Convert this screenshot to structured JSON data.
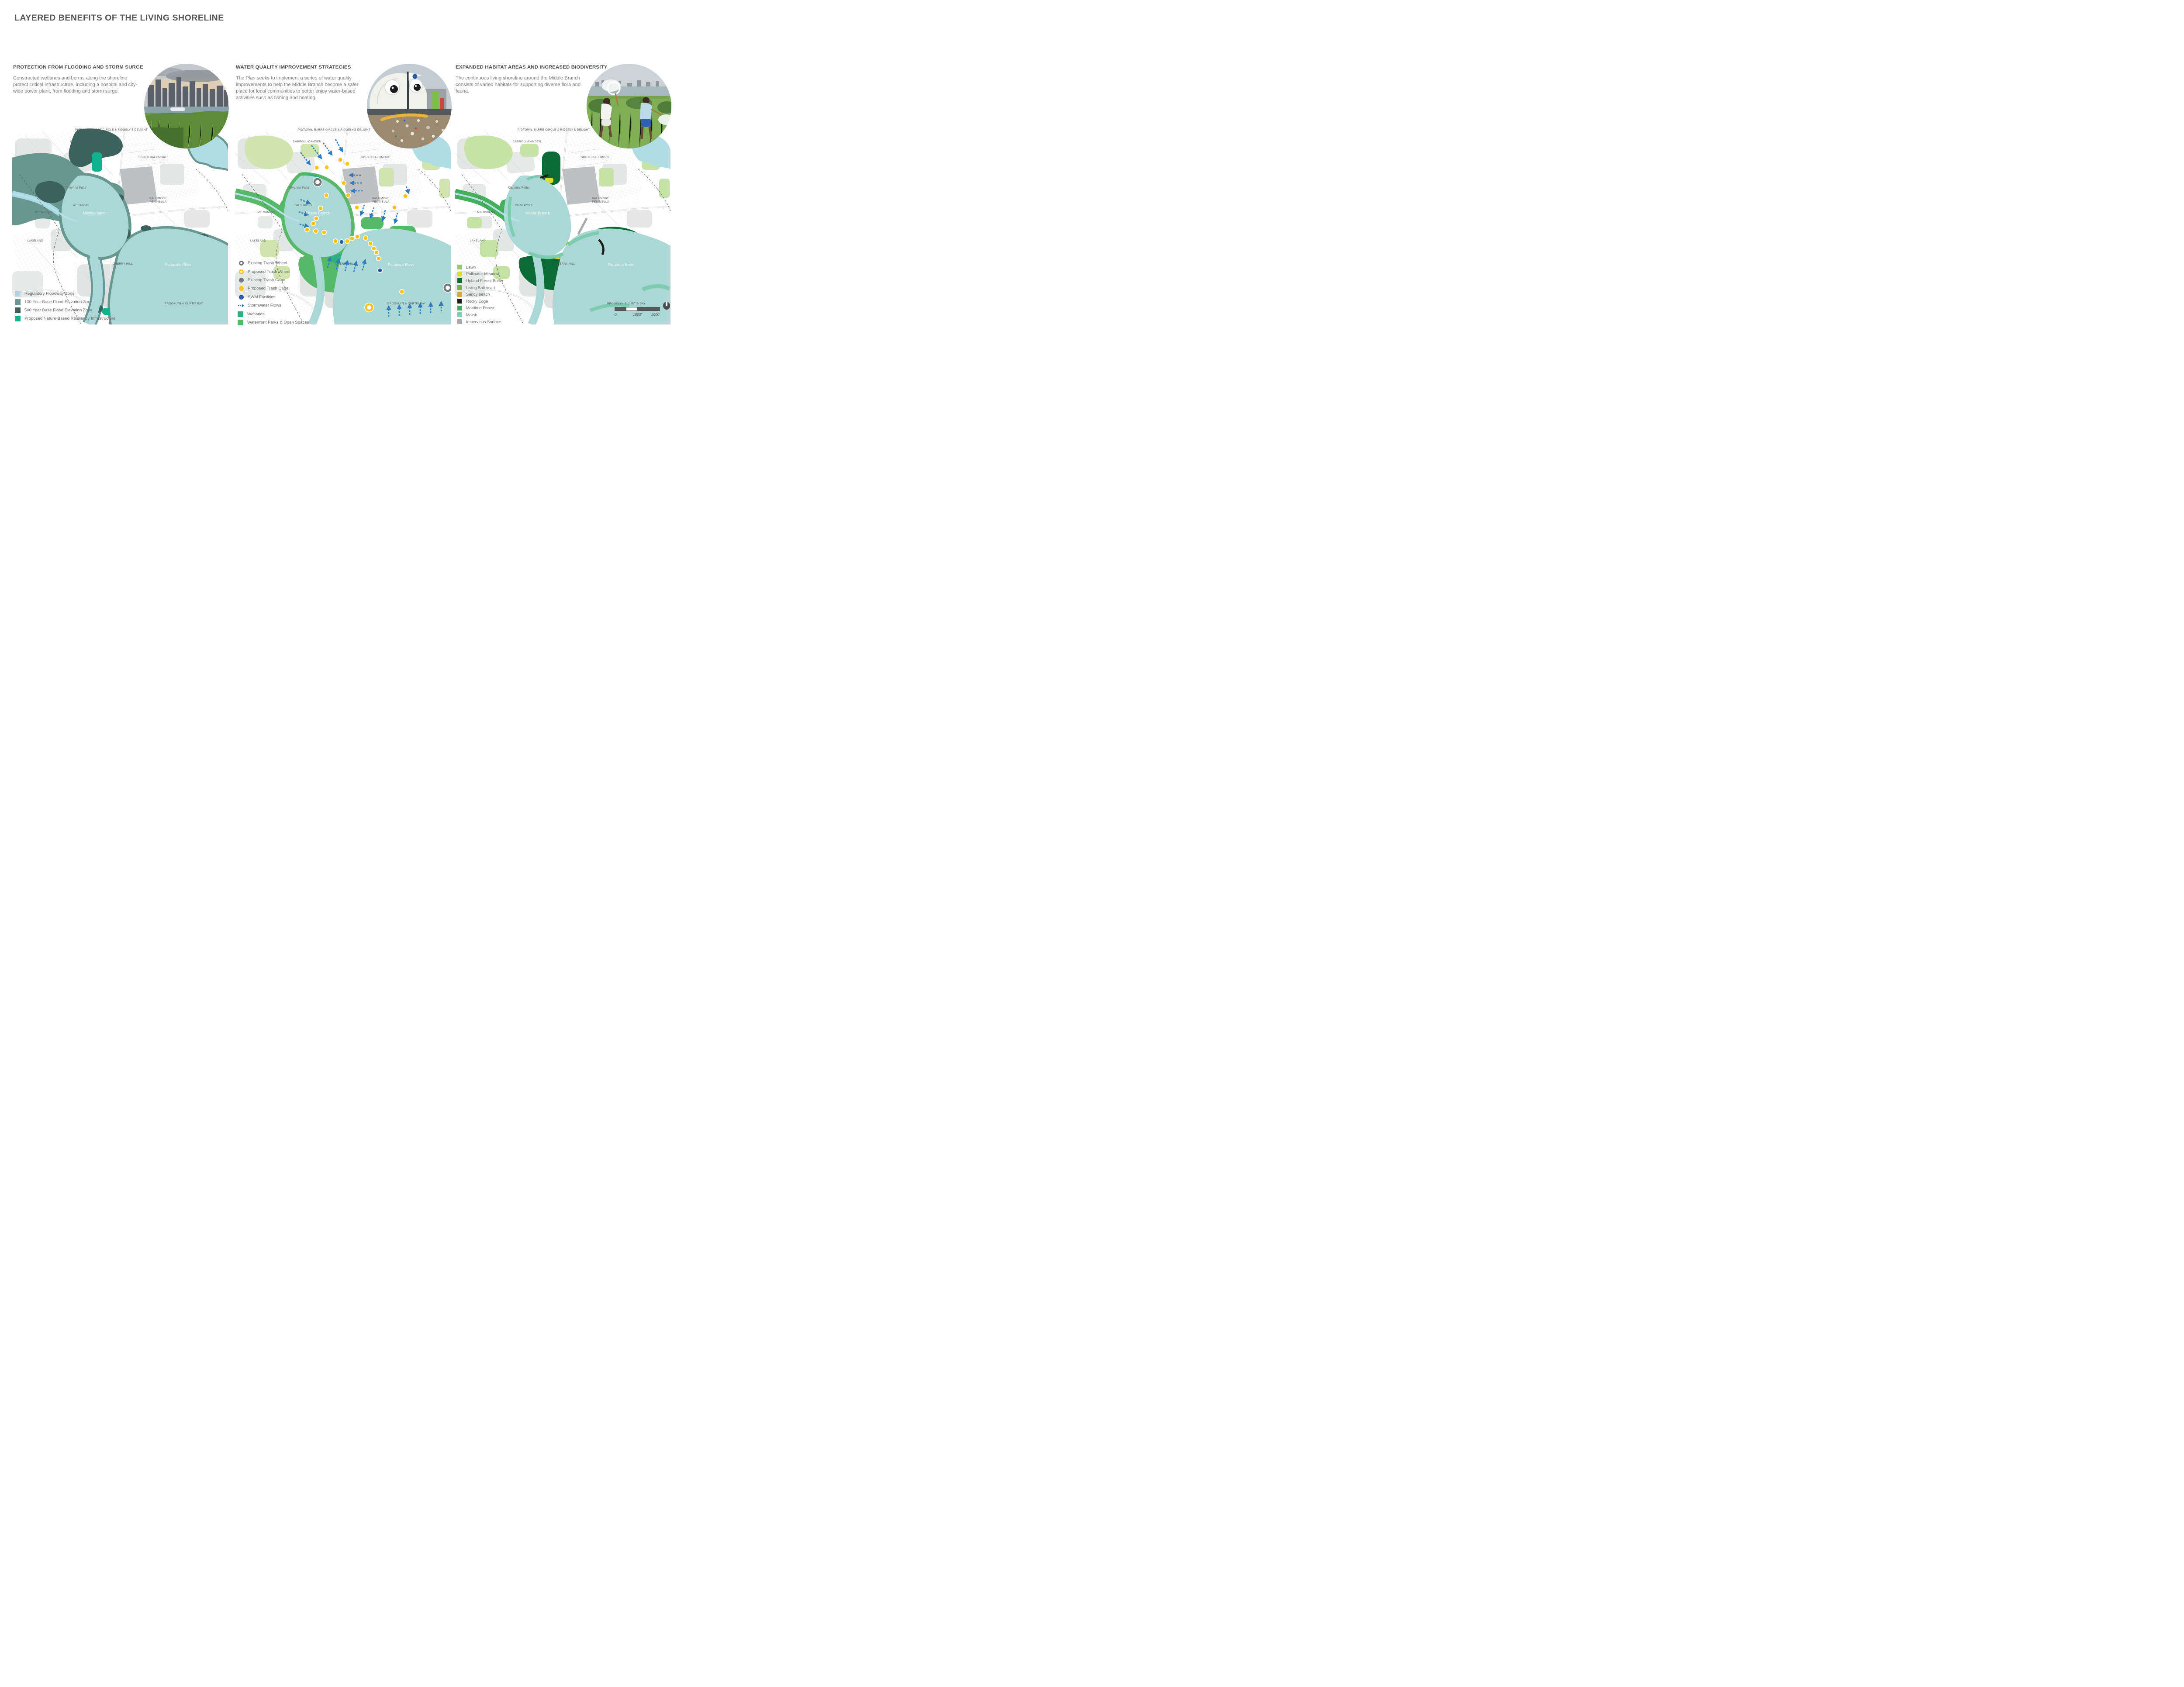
{
  "page_title": "LAYERED BENEFITS OF THE LIVING SHORELINE",
  "panels": [
    {
      "heading": "PROTECTION FROM FLOODING AND STORM SURGE",
      "body": "Constructed wetlands and berms along the shoreline protect critical infrastructure, including a hospital and city-wide power plant, from flooding and storm surge.",
      "photo": "constructed-wetland-with-city-skyline"
    },
    {
      "heading": "WATER QUALITY IMPROVEMENT STRATEGIES",
      "body": "The Plan seeks to implement a series of water quality improvements to help the Middle Branch become a safer place for local communities to better enjoy water-based activities such as fishing and boating.",
      "photo": "trash-wheel-with-googly-eyes"
    },
    {
      "heading": "EXPANDED HABITAT AREAS AND INCREASED BIODIVERSITY",
      "body": "The continuous living shoreline around the Middle Branch consists of varied habitats for supporting diverse flora and fauna.",
      "photo": "children-with-nets-in-meadow"
    }
  ],
  "map_labels": {
    "pigtown": "PIGTOWN, BARRE CIRCLE & RIDGELY'S DELIGHT",
    "carroll": "CARROLL-CAMDEN",
    "south_baltimore": "SOUTH BALTIMORE",
    "baltimore_peninsula": "BALTIMORE PENINSULA",
    "westport": "WESTPORT",
    "mt_winans": "MT. WINANS",
    "lakeland": "LAKELAND",
    "cherry_hill": "CHERRY HILL",
    "brooklyn": "BROOKLYN & CURTIS BAY",
    "gwynns_falls": "Gwynns Falls",
    "middle_branch": "Middle Branch",
    "patapsco_river": "Patapsco River"
  },
  "legends": {
    "flooding": [
      {
        "label": "Regulatory Floodway Zone",
        "color": "#a7dce6"
      },
      {
        "label": "100 Year Base Flood Elevation Zone",
        "color": "#68978f"
      },
      {
        "label": "500 Year Base Flood Elevation Zone",
        "color": "#3c625c"
      },
      {
        "label": "Proposed Nature-Based Resiliency Infrastructure",
        "color": "#10b28b"
      }
    ],
    "water_quality": [
      {
        "label": "Existing Trash Wheel",
        "color": "#77787b"
      },
      {
        "label": "Proposed Trash Wheel",
        "color": "#ffc20e"
      },
      {
        "label": "Existing Trash Cage",
        "color": "#77787b"
      },
      {
        "label": "Proposed Trash Cage",
        "color": "#ffc20e"
      },
      {
        "label": "SWM Facilities",
        "color": "#2b5ca9"
      },
      {
        "label": "Stormwater Flows",
        "color": "#2f7bc1"
      },
      {
        "label": "Wetlands",
        "color": "#2fae84"
      },
      {
        "label": "Waterfront Parks & Open Spaces",
        "color": "#55b968"
      }
    ],
    "habitat": [
      {
        "label": "Lawn",
        "color": "#94ca6e"
      },
      {
        "label": "Pollinator Meadow",
        "color": "#d9e02b"
      },
      {
        "label": "Upland Forest Buffer",
        "color": "#0a6b35"
      },
      {
        "label": "Living Bulkhead",
        "color": "#72b43e"
      },
      {
        "label": "Sandy beach",
        "color": "#d2a93b"
      },
      {
        "label": "Rocky Edge",
        "color": "#1d1d1b"
      },
      {
        "label": "Maritime Forest",
        "color": "#43b05c"
      },
      {
        "label": "Marsh",
        "color": "#7dccb0"
      },
      {
        "label": "Impervious Surface",
        "color": "#a8aaad"
      }
    ]
  },
  "scale_bar": {
    "zero": "0",
    "mid": "1000'",
    "end": "2000'"
  },
  "colors": {
    "water": "#abd8d7",
    "harbor_water": "#b2dce4",
    "stream": "#b9dfe8",
    "urban_gray": "#e4e5e5",
    "port_gray": "#bfc0c1",
    "arrow_blue": "#2f7bc1",
    "title_gray": "#56575a"
  }
}
